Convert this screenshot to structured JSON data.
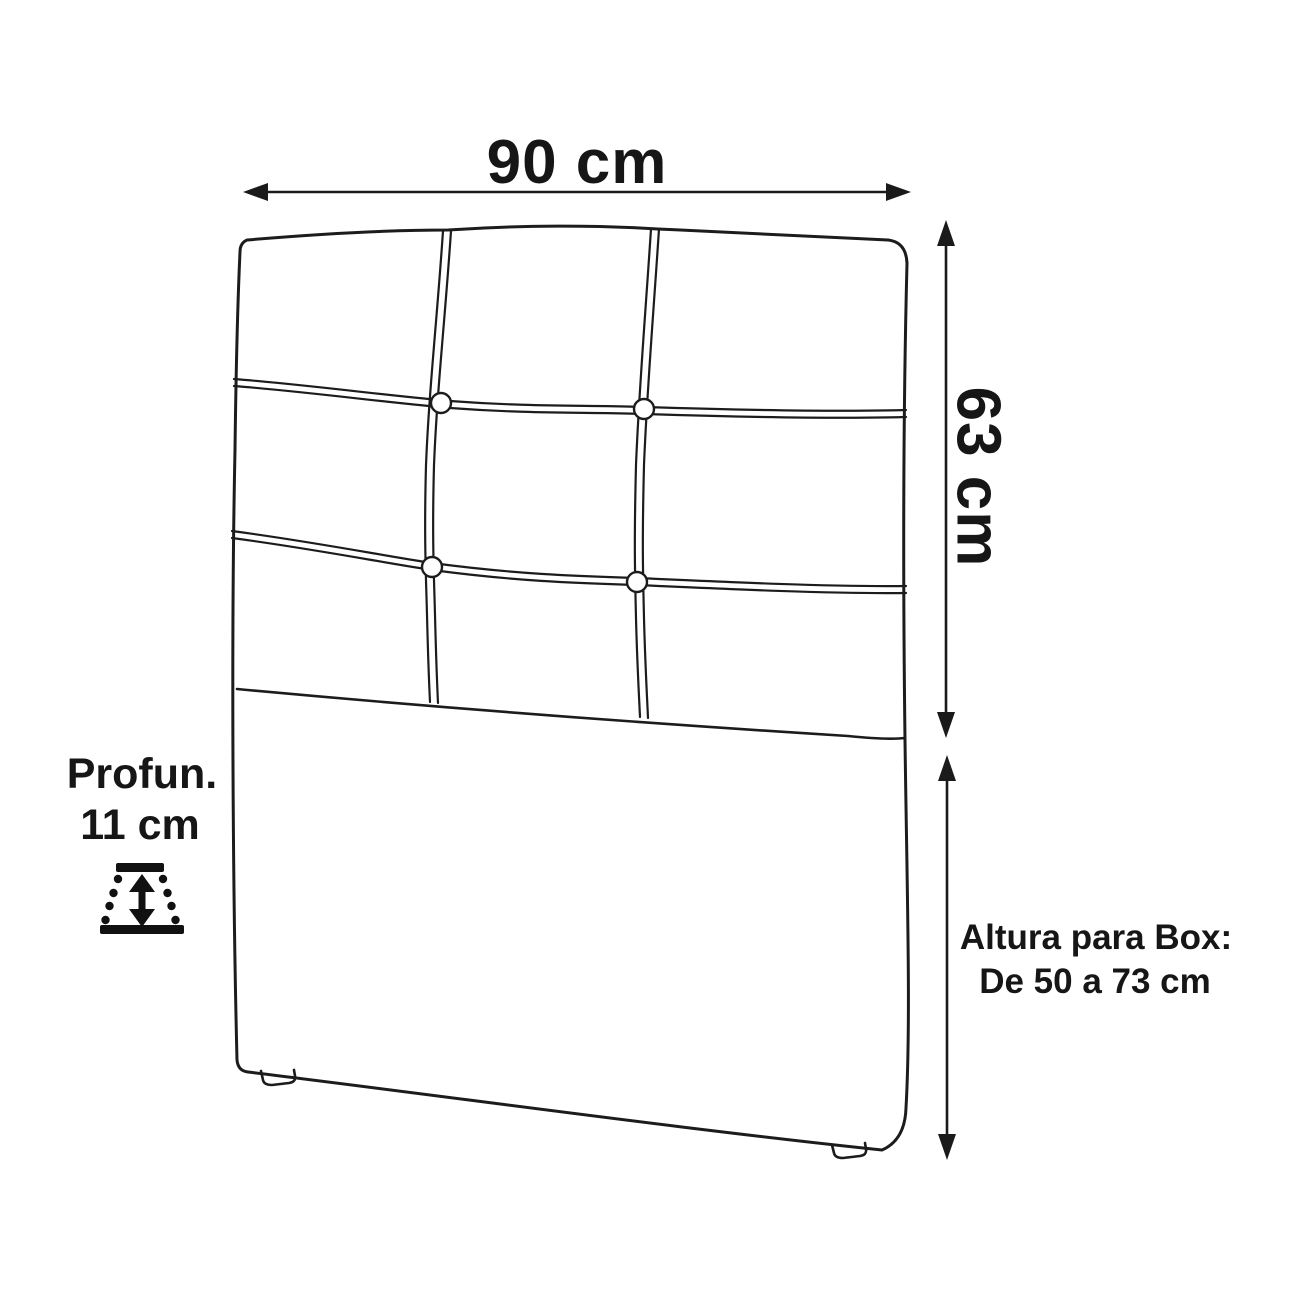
{
  "diagram": {
    "description": "Headboard dimension diagram with tufted 3x3 panel",
    "background_color": "#ffffff",
    "line_color": "#1c1c1c",
    "text_color": "#161616",
    "dimensions": {
      "width": {
        "label": "90 cm"
      },
      "height": {
        "label": "63 cm"
      },
      "depth": {
        "label_line1": "Profun.",
        "label_line2": "11 cm"
      },
      "box_height": {
        "label_line1": "Altura para Box:",
        "label_line2": "De 50 a 73 cm"
      }
    },
    "tufting": {
      "rows_upper_panel": 3,
      "columns": 3,
      "button_count": 4
    }
  }
}
